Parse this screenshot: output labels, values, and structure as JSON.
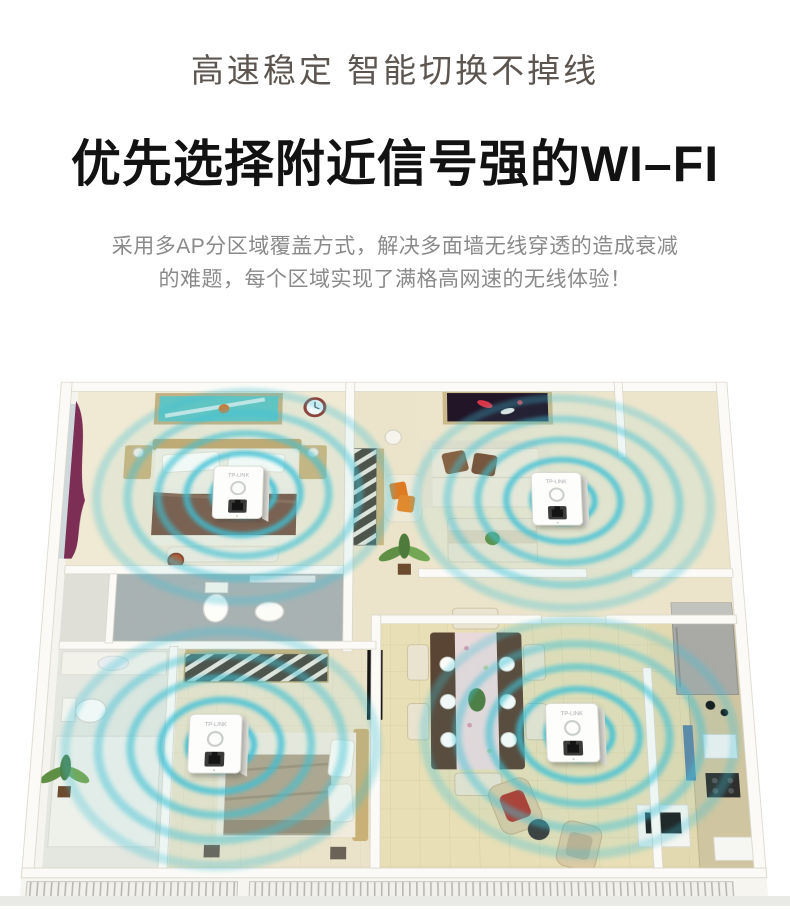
{
  "header": {
    "subtitle": "高速稳定 智能切换不掉线",
    "title": "优先选择附近信号强的WI–FI",
    "description_line1": "采用多AP分区域覆盖方式，解决多面墙无线穿透的造成衰减",
    "description_line2": "的难题，每个区域实现了满格高网速的无线体验！"
  },
  "illustration": {
    "ap_label": "TP-LINK",
    "ap_count": 4,
    "signal_color": "#3fc0d4"
  }
}
